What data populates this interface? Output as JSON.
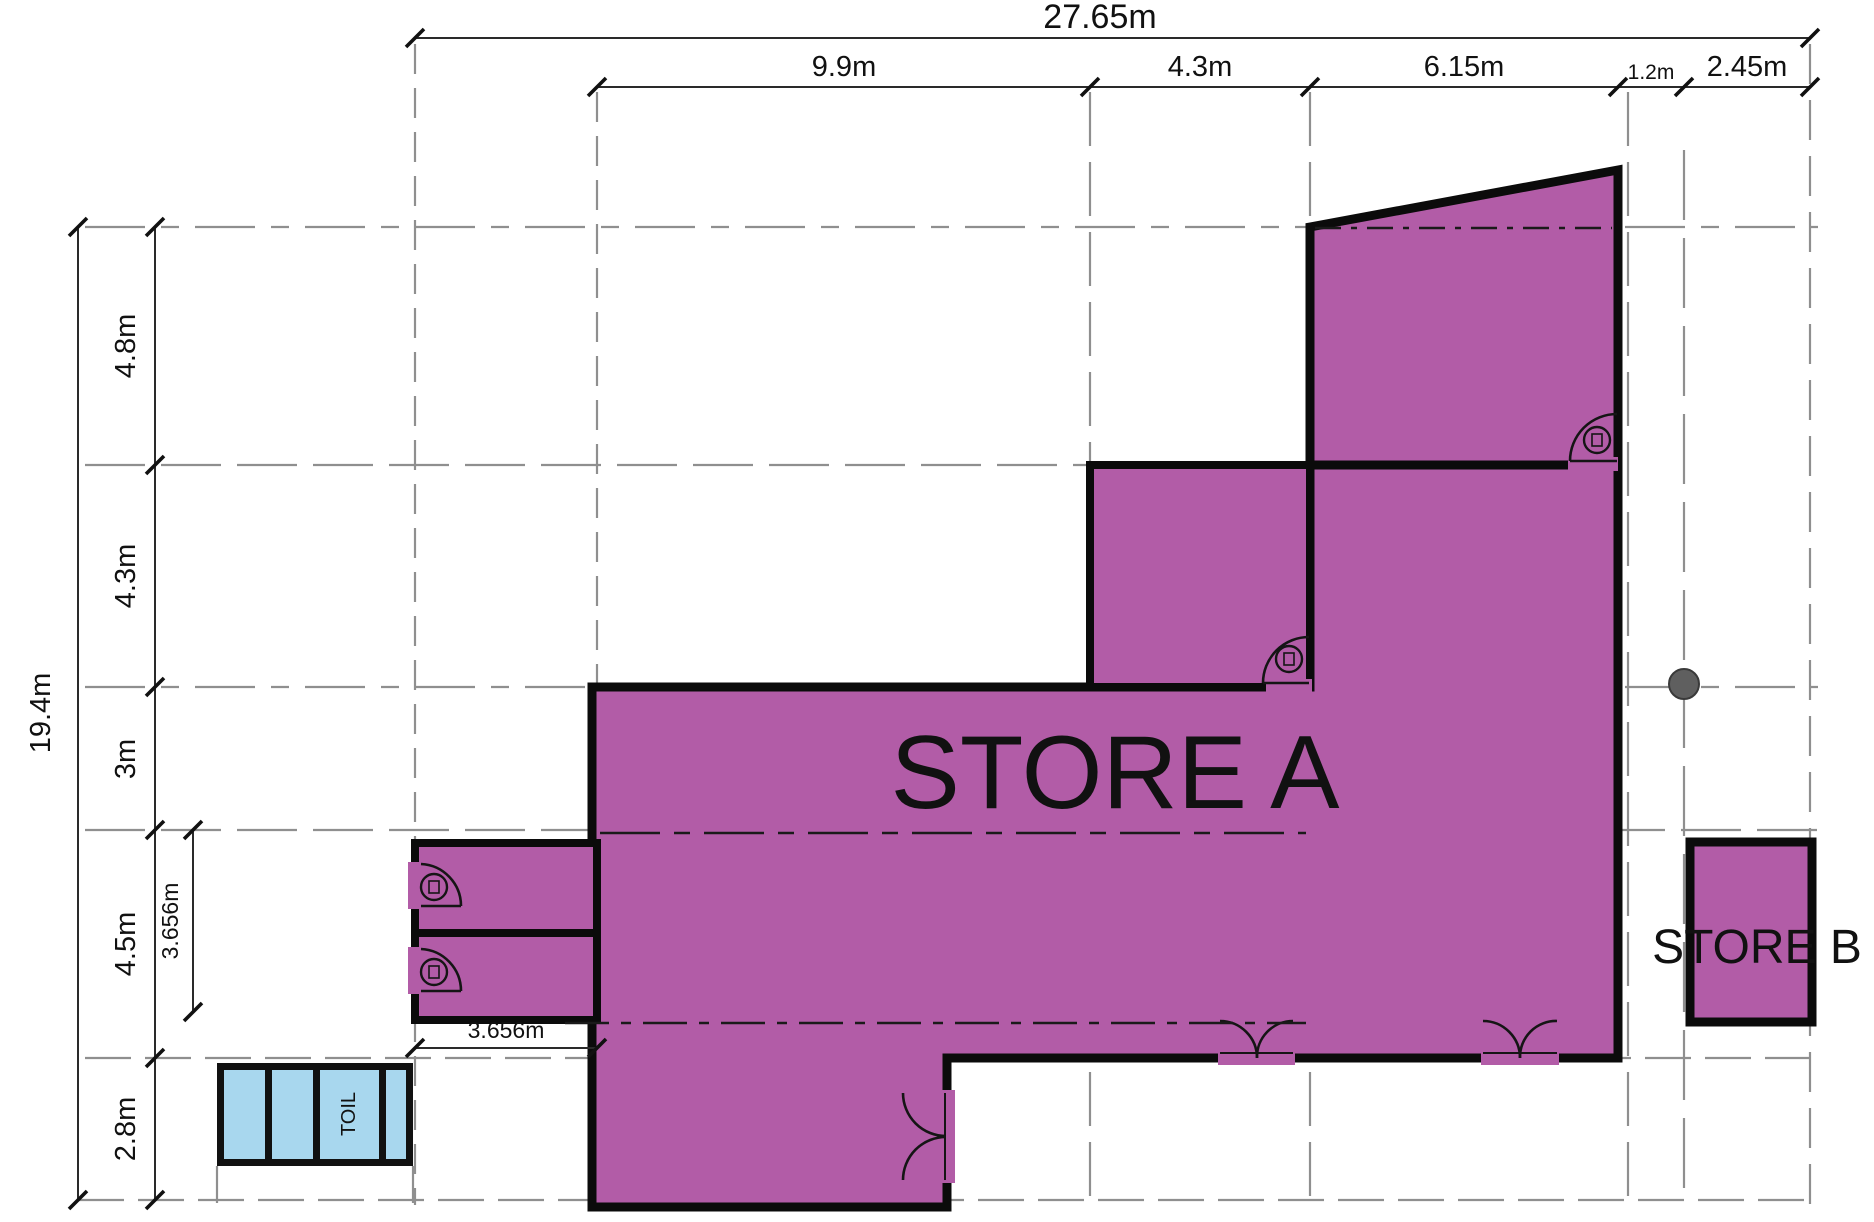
{
  "plan": {
    "rooms": {
      "store_a": "STORE A",
      "store_b": "STORE B",
      "toilet": "TOIL"
    },
    "dimensions": {
      "top_total": "27.65m",
      "top_segments": [
        "9.9m",
        "4.3m",
        "6.15m",
        "1.2m",
        "2.45m"
      ],
      "left_total": "19.4m",
      "left_segments": [
        "4.8m",
        "4.3m",
        "3m",
        "4.5m",
        "2.8m"
      ],
      "inner_vertical": "3.656m",
      "inner_horizontal": "3.656m"
    },
    "colors": {
      "store_fill": "#b25ca7",
      "wall": "#0b0b0b",
      "toilet_fill": "#a8d7ee",
      "grid_line": "#8f8f8f",
      "dimension_line": "#2a2a2a",
      "survey_dot": "#5f5f5f"
    }
  }
}
